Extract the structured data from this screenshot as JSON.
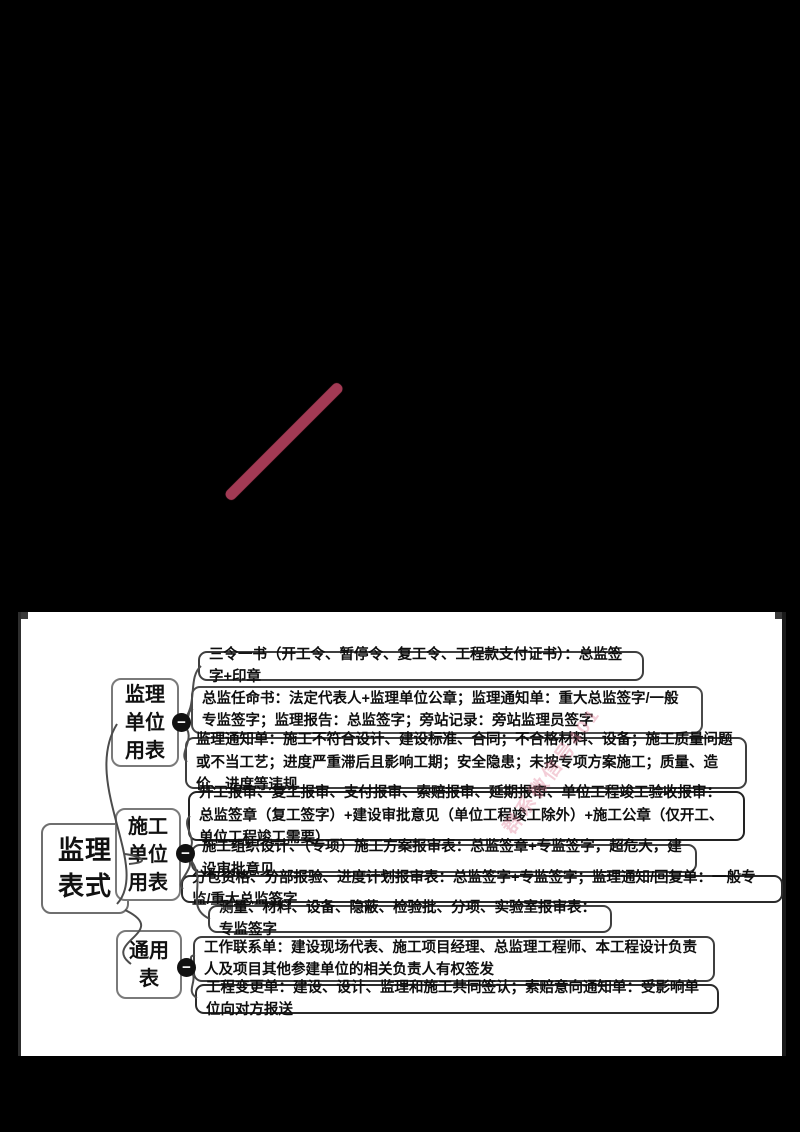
{
  "canvas": {
    "stripe_color": "#a23a54",
    "watermark_text": "群系微信号401"
  },
  "mindmap": {
    "root": {
      "label": "监理\n表式"
    },
    "branches": [
      {
        "label": "监理\n单位\n用表",
        "toggle": "−"
      },
      {
        "label": "施工\n单位\n用表",
        "toggle": "−"
      },
      {
        "label": "通用\n表",
        "toggle": "−"
      }
    ],
    "leaves": [
      {
        "branch": 0,
        "text": "三令一书（开工令、暂停令、复工令、工程款支付证书）：总监签字+印章"
      },
      {
        "branch": 0,
        "text": "总监任命书：法定代表人+监理单位公章；监理通知单：重大总监签字/一般专监签字；监理报告：总监签字；旁站记录：旁站监理员签字"
      },
      {
        "branch": 0,
        "text": "监理通知单：施工不符合设计、建设标准、合同；不合格材料、设备；施工质量问题或不当工艺；进度严重滞后且影响工期；安全隐患；未按专项方案施工；质量、造价、进度等违规"
      },
      {
        "branch": 1,
        "text": "开工报审、复工报审、支付报审、索赔报审、延期报审、单位工程竣工验收报审：总监签章（复工签字）+建设审批意见（单位工程竣工除外）+施工公章（仅开工、单位工程竣工需要）"
      },
      {
        "branch": 1,
        "text": "施工组织设计、（专项）施工方案报审表：总监签章+专监签字，超危大，建设审批意见"
      },
      {
        "branch": 1,
        "text": "分包资格、分部报验、进度计划报审表：总监签字+专监签字；监理通知/回复单：一般专监/重大总监签字"
      },
      {
        "branch": 1,
        "text": "测量、材料、设备、隐蔽、检验批、分项、实验室报审表：专监签字"
      },
      {
        "branch": 2,
        "text": "工作联系单：建设现场代表、施工项目经理、总监理工程师、本工程设计负责人及项目其他参建单位的相关负责人有权签发"
      },
      {
        "branch": 2,
        "text": "工程变更单：建设、设计、监理和施工共同签认；索赔意向通知单：受影响单位向对方报送"
      }
    ]
  }
}
